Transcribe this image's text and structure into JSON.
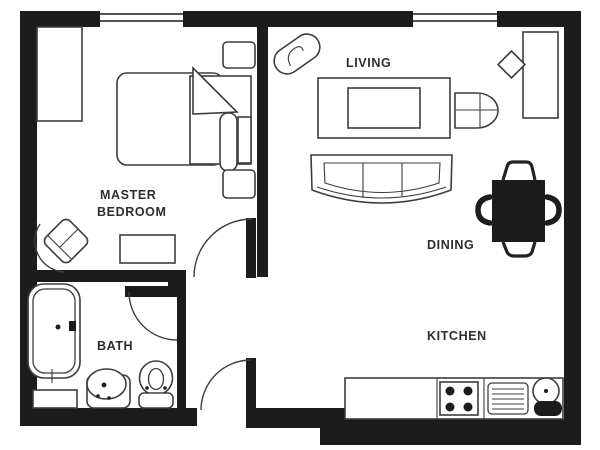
{
  "title": "One-bedroom apartment floor plan",
  "colors": {
    "wall": "#1c1c1c",
    "furniture_line": "#3d3d3d",
    "background": "#ffffff",
    "text": "#2e2e2e"
  },
  "rooms": [
    {
      "name": "Master Bedroom",
      "label_lines": [
        "MASTER",
        "BEDROOM"
      ],
      "furniture": [
        "closet",
        "double-bed",
        "pillow",
        "nightstand",
        "nightstand",
        "armchair",
        "ottoman"
      ]
    },
    {
      "name": "Living",
      "label_lines": [
        "LIVING"
      ],
      "furniture": [
        "plant",
        "coffee-table",
        "armchair",
        "sofa",
        "desk",
        "desk-chair"
      ]
    },
    {
      "name": "Dining",
      "label_lines": [
        "DINING"
      ],
      "furniture": [
        "dining-table",
        "chair-top",
        "chair-bottom",
        "chair-left",
        "chair-right"
      ]
    },
    {
      "name": "Kitchen",
      "label_lines": [
        "KITCHEN"
      ],
      "furniture": [
        "counter",
        "stove-4-burners",
        "drainer",
        "sink"
      ]
    },
    {
      "name": "Bath",
      "label_lines": [
        "BATH"
      ],
      "furniture": [
        "bathtub",
        "bath-mat",
        "pedestal-sink",
        "toilet"
      ]
    }
  ],
  "features": {
    "windows": 2,
    "doors": [
      "bedroom-door",
      "bathroom-door",
      "entry-door"
    ]
  }
}
